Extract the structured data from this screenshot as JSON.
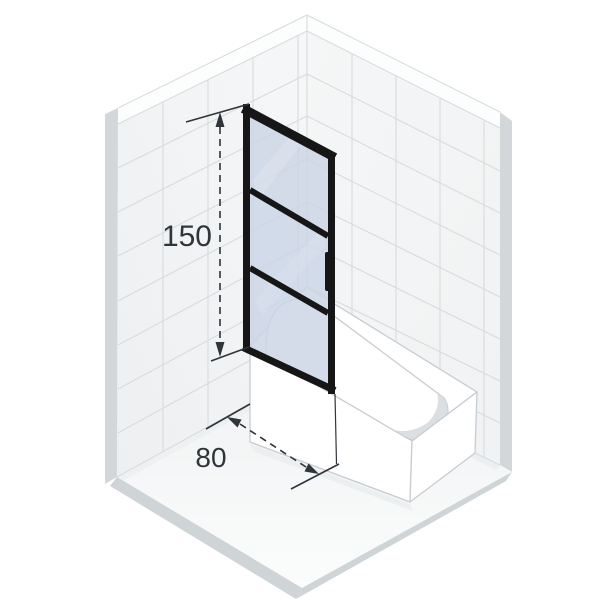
{
  "scene": {
    "dimension_labels": {
      "height": "150",
      "width": "80"
    },
    "screen": {
      "glass_panel_count": 3,
      "handle_position": "right-edge-middle"
    },
    "colors": {
      "background": "#ffffff",
      "tile": "#f3f5f6",
      "grout": "#d8dbde",
      "wall_edge": "#d3d7da",
      "slab_edge": "#cfd4d7",
      "floor": "#f6f8f9",
      "tub_white": "#ffffff",
      "tub_outline": "#c7ccd1",
      "basin_shadow": "#d5d9dc",
      "frame_black": "#161616",
      "glass_blue": "#ccd5e6",
      "dimension": "#303539"
    }
  }
}
